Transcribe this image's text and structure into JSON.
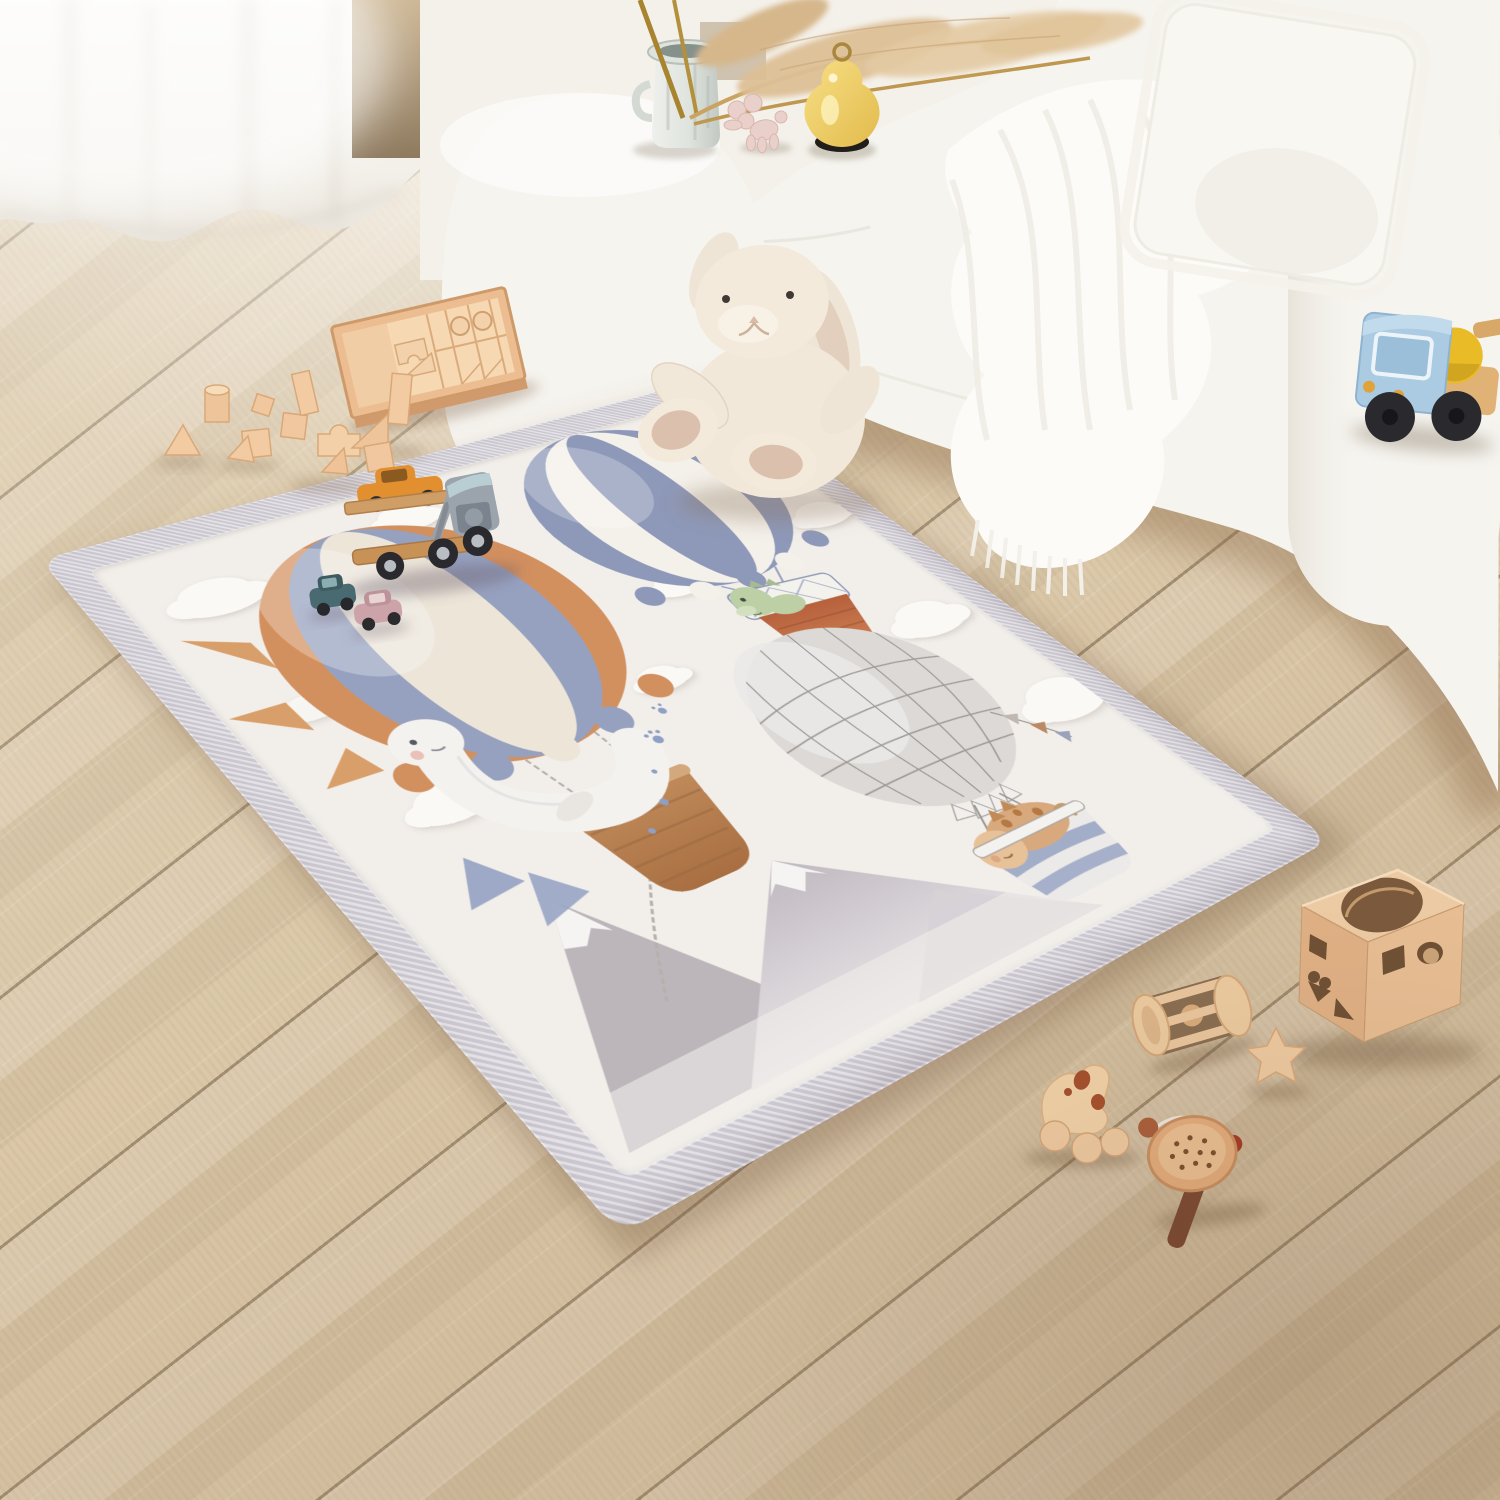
{
  "scene": {
    "description": "Bright nursery corner: a cream padded hot-air-balloon play mat lies on a light oak plank floor beside a curved white boucle sofa; a plush bunny and natural wooden toys are scattered around",
    "window": {
      "curtain": "sheer white curtain with soft folds",
      "light": "bright daylight from the left"
    },
    "floor": {
      "material": "light oak laminate planks",
      "layout": "diagonal"
    },
    "sofa": {
      "type": "curved white boucle sofa",
      "pillow": "white boucle square cushion",
      "throw": "white knit throw with fringe tassels"
    },
    "decor": {
      "vase": {
        "type": "grey ceramic jar with side handles",
        "contents": "dried pampas grass and reed stems"
      },
      "pear_lamp": {
        "body": "butter yellow glass pear",
        "base": "black disc",
        "topper": "brass ring"
      },
      "balloon_dog": {
        "figure": "pale pink balloon-dog figurine"
      },
      "wall_panel": "cream wall paneling at top right"
    },
    "rug": {
      "type": "thick padded baby play mat",
      "border": "ribbed pale-grey binding",
      "field": "warm cream",
      "artwork": {
        "left_balloon": {
          "stripes": [
            "orange",
            "periwinkle",
            "cream"
          ],
          "passenger": "white sea creature with rosy cheek",
          "basket": "woven tan basket on rope chains",
          "extras": [
            "orange sun rays",
            "blue paw prints",
            "blue tail fins",
            "dangling chain"
          ]
        },
        "top_balloon": {
          "stripes": [
            "periwinkle",
            "white"
          ],
          "rim": "white lattice frame",
          "basket": "rust orange",
          "passenger": "green dinosaur with spikes"
        },
        "right_balloon": {
          "style": "grey net-pattern envelope with bunting flags",
          "basket": "blue striped tub",
          "passenger": "tan dinosaur with brown spots"
        },
        "mountains": "grey watercolor peaks with white snow caps",
        "clouds": "embossed puffy white clouds"
      }
    },
    "toys": [
      {
        "name": "plush bunny",
        "color": "cream, floppy ears",
        "location": "sitting on rug corner against sofa"
      },
      {
        "name": "car carrier truck",
        "details": "wooden double deck, grey cab with animal face, orange car on top",
        "location": "on rug, left balloon"
      },
      {
        "name": "mini car",
        "color": "teal",
        "location": "on rug"
      },
      {
        "name": "mini car",
        "color": "dusty pink",
        "location": "on rug"
      },
      {
        "name": "block tray",
        "details": "wooden tray filled with natural building blocks",
        "location": "floor, upper left"
      },
      {
        "name": "scattered blocks",
        "count": 12,
        "location": "floor, left"
      },
      {
        "name": "crane truck",
        "details": "light blue cab, yellow duck driver, black wheels, wooden boom",
        "location": "on sofa seat, right"
      },
      {
        "name": "shape sorter cube",
        "holes": [
          "circle",
          "square",
          "heart",
          "triangle"
        ],
        "location": "floor, bottom right"
      },
      {
        "name": "roller rattle",
        "details": "wooden cylinder with slats and bead",
        "location": "floor, bottom right"
      },
      {
        "name": "star block",
        "location": "floor, bottom right"
      },
      {
        "name": "push-along animal",
        "details": "flat wooden animal with ball wheels and red-brown patches",
        "location": "floor, bottom right"
      },
      {
        "name": "hammer rattle",
        "details": "perforated wooden disc, dark handle, red beads on cord",
        "location": "floor, bottom right"
      }
    ]
  },
  "palette": {
    "floor_light": "#e6d6ba",
    "floor_mid": "#d5c1a1",
    "floor_dark": "#c3a97f",
    "floor_seam": "#8f7a5c",
    "curtain": "#f8f6f2",
    "wall_gap": "#c2ab8b",
    "wall_panel": "#efe9dd",
    "sofa": "#f6f4ef",
    "sofa_shade": "#e8e3d8",
    "pillow": "#f9f7f2",
    "blanket": "#fcfbf8",
    "rug_border": "#d9d5dc",
    "rug_field": "#f2efeb",
    "balloon_orange": "#d3905f",
    "balloon_blue": "#96a1bf",
    "balloon_cream": "#ece5d8",
    "stripe_blue": "#8e99b9",
    "stripe_white": "#f4f1ea",
    "net_grey": "#dcd9d6",
    "net_line": "#948f8b",
    "basket_tan": "#c08a5a",
    "basket_rust": "#bd6b43",
    "basket_blue": "#9aa6c4",
    "dino_green": "#bccfa5",
    "dino_tan": "#d9a97e",
    "dino_spot": "#b57a43",
    "creature_white": "#f4f2ee",
    "fin_blue": "#93a1c2",
    "paw_blue": "#8ea0c4",
    "mountain_light": "#d6d1d6",
    "mountain_mid": "#c9c3c9",
    "mountain_dark": "#b6afb6",
    "snow": "#f6f4f2",
    "cloud": "#fbf9f6",
    "wood_light": "#f2cba2",
    "wood_mid": "#e2a878",
    "wood_dark": "#c89257",
    "wood_deep": "#7a593c",
    "cab_grey": "#9ba3ac",
    "car_orange": "#e2902f",
    "car_teal": "#486a70",
    "car_pink": "#cba3a9",
    "truck_blue": "#abcbe2",
    "duck_yellow": "#e9bb26",
    "wheel_black": "#2a2a2e",
    "bunny_cream": "#f1e8d9",
    "bunny_shade": "#e2cfbd",
    "bunny_pad": "#dcc0ae",
    "pear_yellow": "#f2d36b",
    "pear_base": "#201d1a",
    "gold": "#a9873c",
    "dog_pink": "#e9d0ca",
    "vase_grey": "#dfe3de",
    "pampas": "#dcbf96",
    "handle_brown": "#7c4a33",
    "bead_red": "#a63b28"
  }
}
